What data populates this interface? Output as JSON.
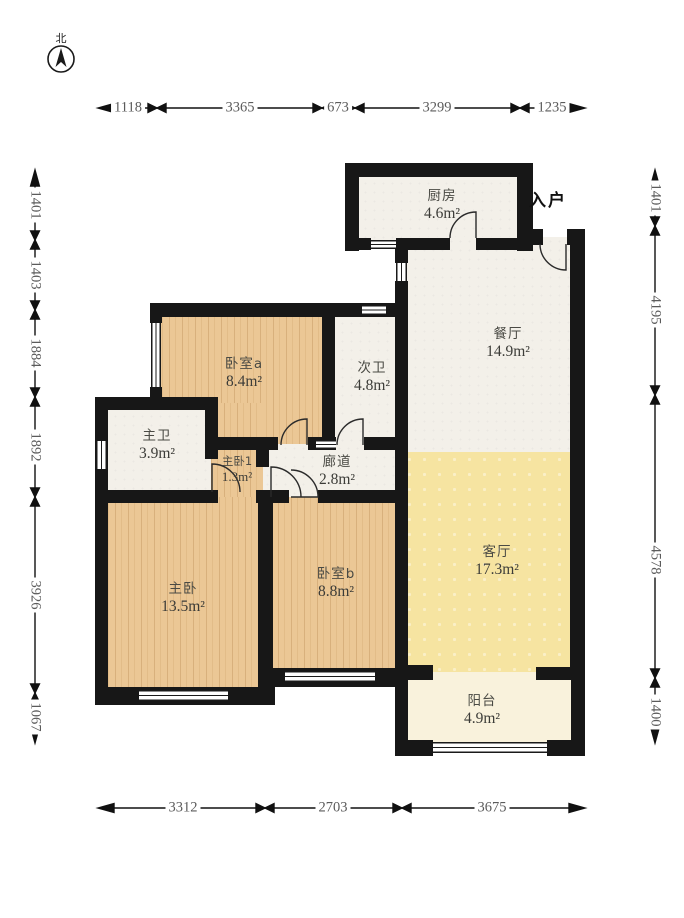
{
  "title": "apartment-floor-plan",
  "compass": {
    "label": "北"
  },
  "entrance": {
    "label": "入户"
  },
  "rooms": [
    {
      "name": "厨房",
      "area": "4.6m²"
    },
    {
      "name": "餐厅",
      "area": "14.9m²"
    },
    {
      "name": "卧室a",
      "area": "8.4m²"
    },
    {
      "name": "次卫",
      "area": "4.8m²"
    },
    {
      "name": "主卫",
      "area": "3.9m²"
    },
    {
      "name": "主卧1",
      "area": "1.3m²"
    },
    {
      "name": "廊道",
      "area": "2.8m²"
    },
    {
      "name": "主卧",
      "area": "13.5m²"
    },
    {
      "name": "卧室b",
      "area": "8.8m²"
    },
    {
      "name": "客厅",
      "area": "17.3m²"
    },
    {
      "name": "阳台",
      "area": "4.9m²"
    }
  ],
  "dimensions": {
    "top": [
      "1118",
      "3365",
      "673",
      "3299",
      "1235"
    ],
    "left": [
      "1401",
      "1403",
      "1884",
      "1892",
      "3926",
      "1067"
    ],
    "right": [
      "1401",
      "4195",
      "4578",
      "1400"
    ],
    "bottom": [
      "3312",
      "2703",
      "3675"
    ]
  },
  "colors": {
    "wall": "#171717",
    "wood_floor": "#ebc795",
    "tile_floor": "#f3f0e9",
    "living_floor": "#f6e4a1",
    "balcony_floor": "#f9f2dc"
  }
}
